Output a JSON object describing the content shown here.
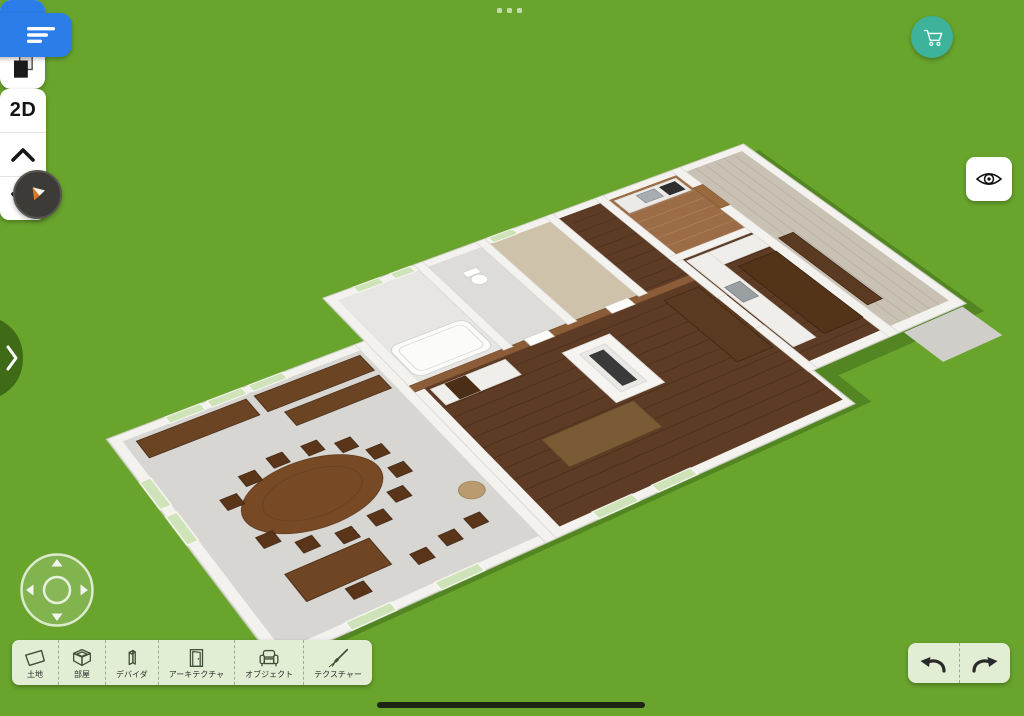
{
  "app": {
    "name": "home-design-3d-editor",
    "view": "3d-floorplan"
  },
  "colors": {
    "ground_green": "#69a52d",
    "accent_blue": "#2b7de9",
    "cart_teal": "#3db39c",
    "panel_pale_green": "#e1eed3",
    "drawer_tab_green": "#3f6b17",
    "compass_background": "#3c3b37",
    "compass_needle_orange": "#e0761f",
    "wall_white": "#f3f2ef",
    "floor_dark_wood": "#5d3b24",
    "floor_light_gray": "#d7d6d2",
    "floor_small_kitchen_wood": "#9b6c45",
    "floor_bedroom_beige": "#c9c1b4"
  },
  "top_bar": {
    "drag_handle": {
      "icon": "drag-dots-icon",
      "dot_count": 3
    }
  },
  "left_controls": {
    "menu_button": {
      "icon": "hamburger-menu-icon"
    },
    "snap_button": {
      "icon": "magnet-icon",
      "active": true
    },
    "clone_button": {
      "icon": "copy-pages-icon"
    },
    "compass_button": {
      "icon": "compass-needle-icon"
    },
    "drawer_tab": {
      "icon": "chevron-right-icon"
    },
    "joystick": {
      "icon": "move-joystick-icon"
    }
  },
  "right_controls": {
    "cart_button": {
      "icon": "shopping-cart-icon"
    },
    "view_mode_button": {
      "label": "2D"
    },
    "floor_up_button": {
      "icon": "chevron-up-icon"
    },
    "floor_down_button": {
      "icon": "chevron-down-icon"
    },
    "visibility_button": {
      "icon": "eye-icon"
    },
    "undo_button": {
      "icon": "undo-arrow-icon"
    },
    "redo_button": {
      "icon": "redo-arrow-icon"
    }
  },
  "bottom_toolbar": {
    "items": [
      {
        "id": "land",
        "label": "土地",
        "icon": "land-plot-icon"
      },
      {
        "id": "rooms",
        "label": "部屋",
        "icon": "room-box-icon"
      },
      {
        "id": "dividers",
        "label": "デバイダ",
        "icon": "divider-panel-icon"
      },
      {
        "id": "architecture",
        "label": "アーキテクチャ",
        "icon": "door-icon"
      },
      {
        "id": "objects",
        "label": "オブジェクト",
        "icon": "armchair-icon"
      },
      {
        "id": "textures",
        "label": "テクスチャー",
        "icon": "paintbrush-icon"
      }
    ]
  },
  "system": {
    "home_indicator": true
  }
}
